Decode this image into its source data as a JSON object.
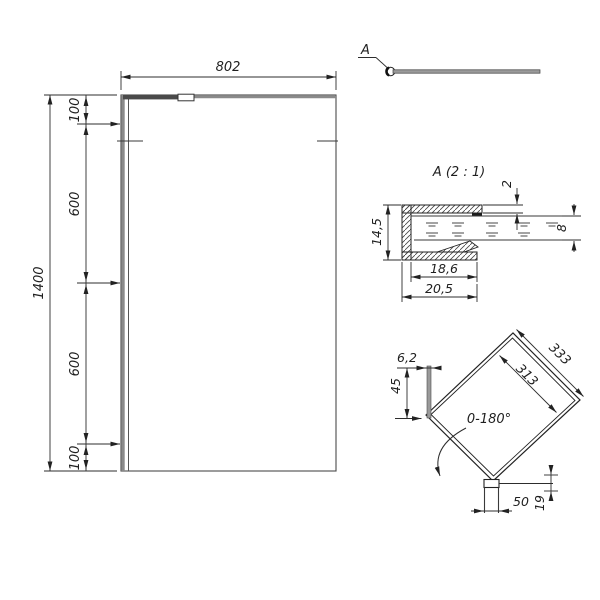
{
  "front_view": {
    "width": "802",
    "height": "1400",
    "segments": [
      "100",
      "600",
      "600",
      "100"
    ]
  },
  "callout": {
    "label": "A"
  },
  "detail_a": {
    "title": "A (2 : 1)",
    "profile_height": "14,5",
    "cover_thickness": "2",
    "glass_thickness": "8",
    "inner_depth": "18,6",
    "outer_depth": "20,5"
  },
  "bar_detail": {
    "bar_length_outer": "333",
    "bar_length_inner": "313",
    "plate_width": "6,2",
    "plate_offset": "45",
    "swing_angle": "0-180°",
    "clamp_width": "50",
    "clamp_height": "19"
  },
  "colors": {
    "line": "#2d2d2d",
    "profile_gray": "#8a8a8a"
  }
}
